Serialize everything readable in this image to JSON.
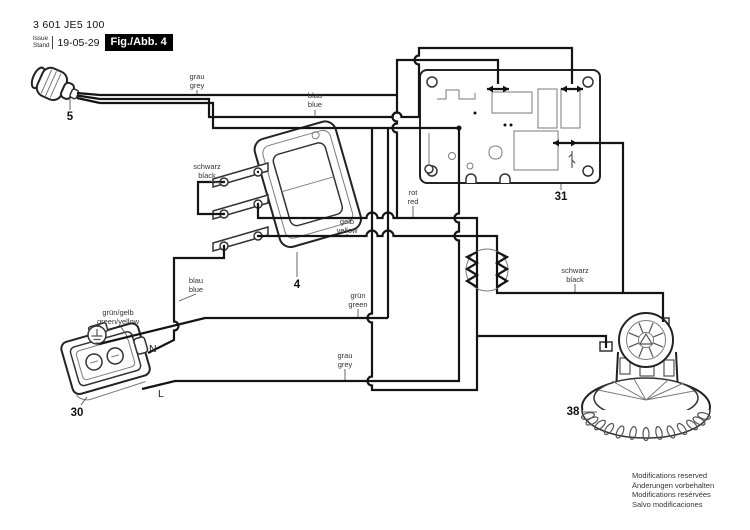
{
  "header": {
    "part_number": "3 601 JE5 100",
    "issue_label": "Issue",
    "stand_label": "Stand",
    "date": "19-05-29",
    "figure_label": "Fig./Abb. 4"
  },
  "refs": {
    "plug": "5",
    "switch": "4",
    "socket": "30",
    "pcb": "31",
    "motor": "38"
  },
  "wire_labels": {
    "grey_top": {
      "de": "grau",
      "en": "grey"
    },
    "blue_top": {
      "de": "blau",
      "en": "blue"
    },
    "black_switch": {
      "de": "schwarz",
      "en": "black"
    },
    "yellow": {
      "de": "gelb",
      "en": "yellow"
    },
    "blue_bottom": {
      "de": "blau",
      "en": "blue"
    },
    "green": {
      "de": "grün",
      "en": "green"
    },
    "red": {
      "de": "rot",
      "en": "red"
    },
    "black_motor": {
      "de": "schwarz",
      "en": "black"
    },
    "grey_bottom": {
      "de": "grau",
      "en": "grey"
    },
    "green_yellow": {
      "de": "grün/gelb",
      "en": "green/yellow"
    }
  },
  "terminals": {
    "neutral": "N",
    "line": "L"
  },
  "footer": {
    "lines": [
      "Modifications reserved",
      "Änderungen vorbehalten",
      "Modifications resérvées",
      "Salvo modificaciones"
    ]
  }
}
